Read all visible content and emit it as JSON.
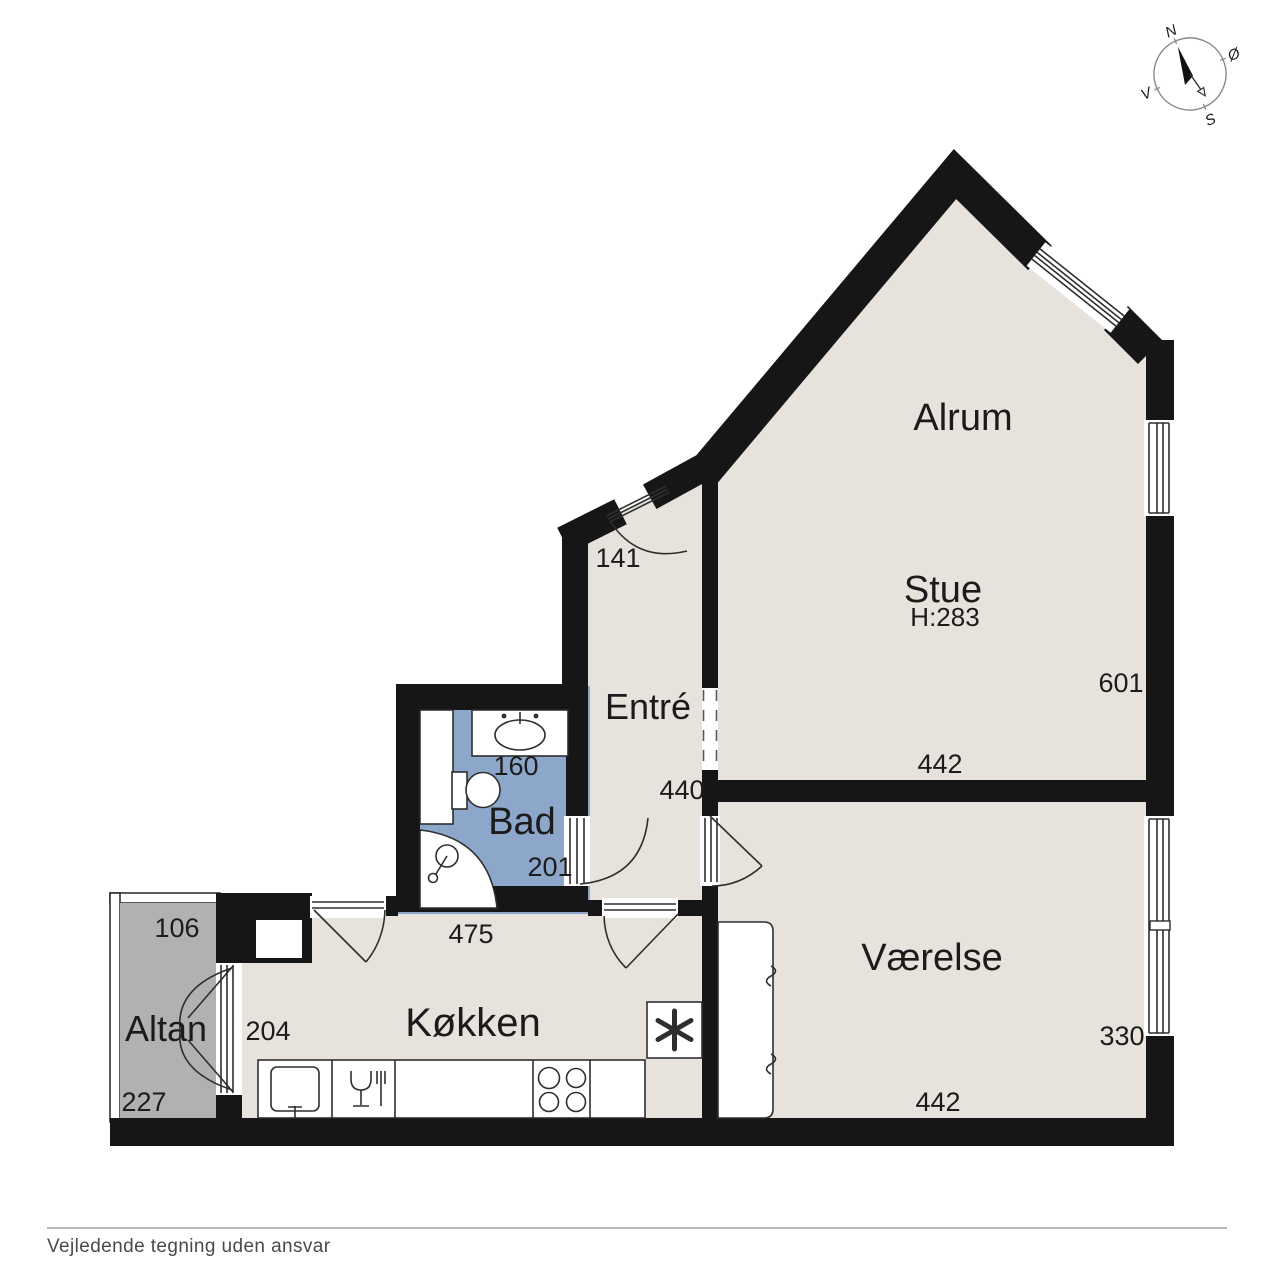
{
  "footer": {
    "disclaimer": "Vejledende tegning uden ansvar"
  },
  "compass": {
    "north": "N",
    "east": "Ø",
    "south": "S",
    "west": "V"
  },
  "colors": {
    "wall": "#161616",
    "floor": "#e7e2db",
    "bathroom_floor": "#8da7cb",
    "balcony_floor": "#b2b1af",
    "footer_text": "#4a4a4a"
  },
  "rooms": {
    "alrum": {
      "label": "Alrum"
    },
    "stue": {
      "label": "Stue",
      "ceiling_height": "H:283",
      "dim_bottom": "442",
      "dim_right": "601"
    },
    "entre": {
      "label": "Entré",
      "dim_entrance": "141",
      "dim_length": "440"
    },
    "bad": {
      "label": "Bad",
      "dim_top": "160",
      "dim_bottom": "201"
    },
    "koekken": {
      "label": "Køkken",
      "dim_top": "475",
      "dim_left": "204"
    },
    "vaerelse": {
      "label": "Værelse",
      "dim_bottom": "442",
      "dim_right": "330"
    },
    "altan": {
      "label": "Altan",
      "dim_top": "106",
      "dim_bottom": "227"
    }
  }
}
